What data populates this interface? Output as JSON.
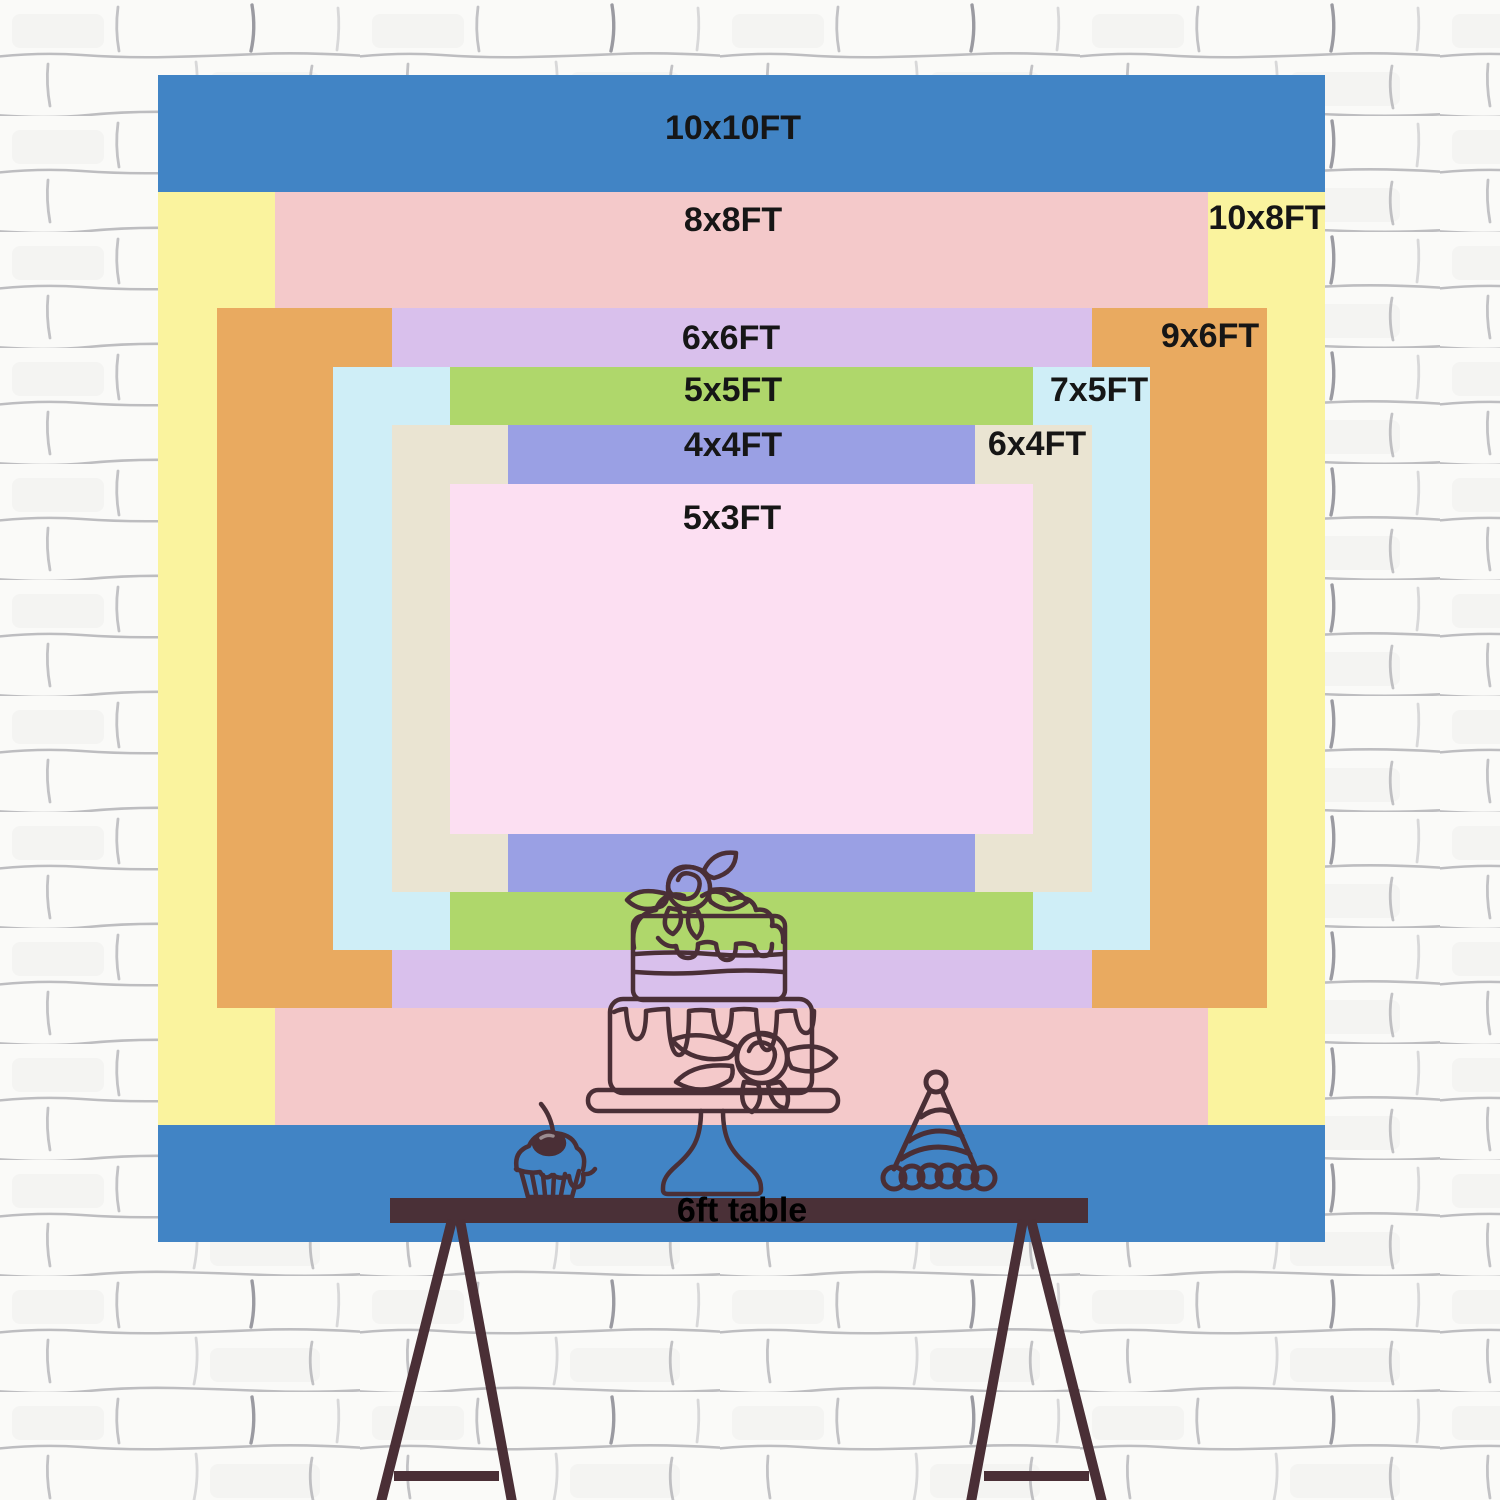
{
  "title": "Backdrop size comparison chart",
  "backdrop": {
    "sizes": [
      {
        "id": "10x10",
        "label": "10x10FT",
        "color": "#4184c5"
      },
      {
        "id": "10x8",
        "label": "10x8FT",
        "color": "#faf39e"
      },
      {
        "id": "8x8",
        "label": "8x8FT",
        "color": "#f4c9ca"
      },
      {
        "id": "9x6",
        "label": "9x6FT",
        "color": "#e9aa60"
      },
      {
        "id": "6x6",
        "label": "6x6FT",
        "color": "#d9c0ec"
      },
      {
        "id": "7x5",
        "label": "7x5FT",
        "color": "#cfeef7"
      },
      {
        "id": "5x5",
        "label": "5x5FT",
        "color": "#afd76b"
      },
      {
        "id": "6x4",
        "label": "6x4FT",
        "color": "#eae4d2"
      },
      {
        "id": "4x4",
        "label": "4x4FT",
        "color": "#9aa0e4"
      },
      {
        "id": "5x3",
        "label": "5x3FT",
        "color": "#fcdff2"
      }
    ]
  },
  "table": {
    "label": "6ft table",
    "color": "#4a3037"
  },
  "illustration": {
    "items": [
      "tiered-cake-icon",
      "cupcake-icon",
      "party-hat-icon",
      "trestle-legs-icon"
    ]
  },
  "theme": {
    "wall_background": "#fafaf8",
    "wall_line": "#8a8a92",
    "illustration_line": "#4a2f36",
    "label_color": "#161616",
    "table_label_color": "#000000"
  }
}
